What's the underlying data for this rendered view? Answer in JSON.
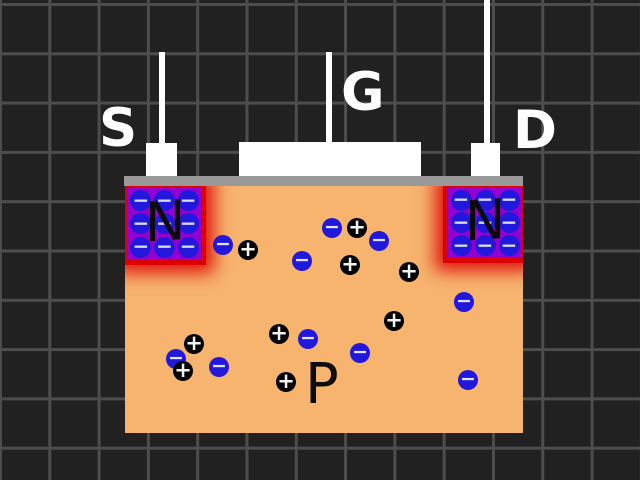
{
  "terminals": {
    "source": {
      "label": "S"
    },
    "gate": {
      "label": "G"
    },
    "drain": {
      "label": "D"
    }
  },
  "regions": {
    "substrate_label": "P",
    "n_region_label": "N",
    "donor_rows": 3,
    "donor_cols": 3
  },
  "particles": {
    "electron_glyph": "−",
    "hole_glyph": "+",
    "electrons": [
      [
        98,
        59
      ],
      [
        177,
        75
      ],
      [
        207,
        42
      ],
      [
        254,
        55
      ],
      [
        339,
        116
      ],
      [
        183,
        153
      ],
      [
        235,
        167
      ],
      [
        51,
        173
      ],
      [
        94,
        181
      ],
      [
        343,
        194
      ]
    ],
    "holes": [
      [
        123,
        64
      ],
      [
        232,
        42
      ],
      [
        225,
        79
      ],
      [
        284,
        86
      ],
      [
        269,
        135
      ],
      [
        154,
        148
      ],
      [
        69,
        158
      ],
      [
        58,
        185
      ],
      [
        161,
        196
      ]
    ]
  },
  "colors": {
    "background": "#212121",
    "grid_line": "#4d4d4d",
    "metal": "#ffffff",
    "oxide": "#999999",
    "substrate": "#F7B46E",
    "n_region": "#9400D0",
    "n_glow": "#DD0000",
    "electron": "#2218DC",
    "hole": "#000000",
    "label_light": "#ffffff",
    "label_dark": "#0d0d0d"
  }
}
